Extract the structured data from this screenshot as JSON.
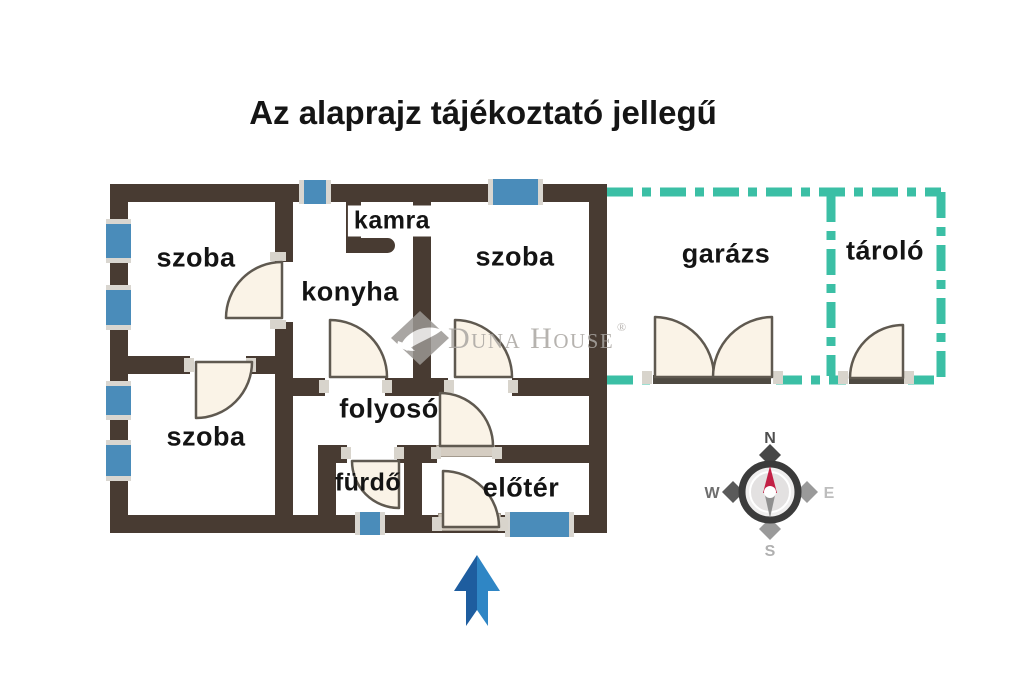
{
  "title": "Az alaprajz tájékoztató jellegű",
  "rooms": {
    "szoba_top_left": "szoba",
    "kamra": "kamra",
    "konyha": "konyha",
    "szoba_top_right": "szoba",
    "szoba_bottom_left": "szoba",
    "folyoso": "folyosó",
    "furdo": "fürdő",
    "eloter": "előtér",
    "garazs": "garázs",
    "tarolo": "tároló"
  },
  "compass": {
    "north": "N",
    "west": "W",
    "east": "E",
    "south": "S"
  },
  "watermark": {
    "brand": "Duna House",
    "registered": "®"
  },
  "colors": {
    "wall": "#483b32",
    "window": "#4a8cba",
    "outbuilding_dashed": "#3bbfa5",
    "door_fill": "#faf3e7",
    "door_stroke": "#5f5950",
    "entrance_arrow_dark": "#1e5d9f",
    "entrance_arrow_light": "#2f86c5",
    "compass_north_needle": "#c22045",
    "watermark_gray": "#aaa6a2"
  }
}
